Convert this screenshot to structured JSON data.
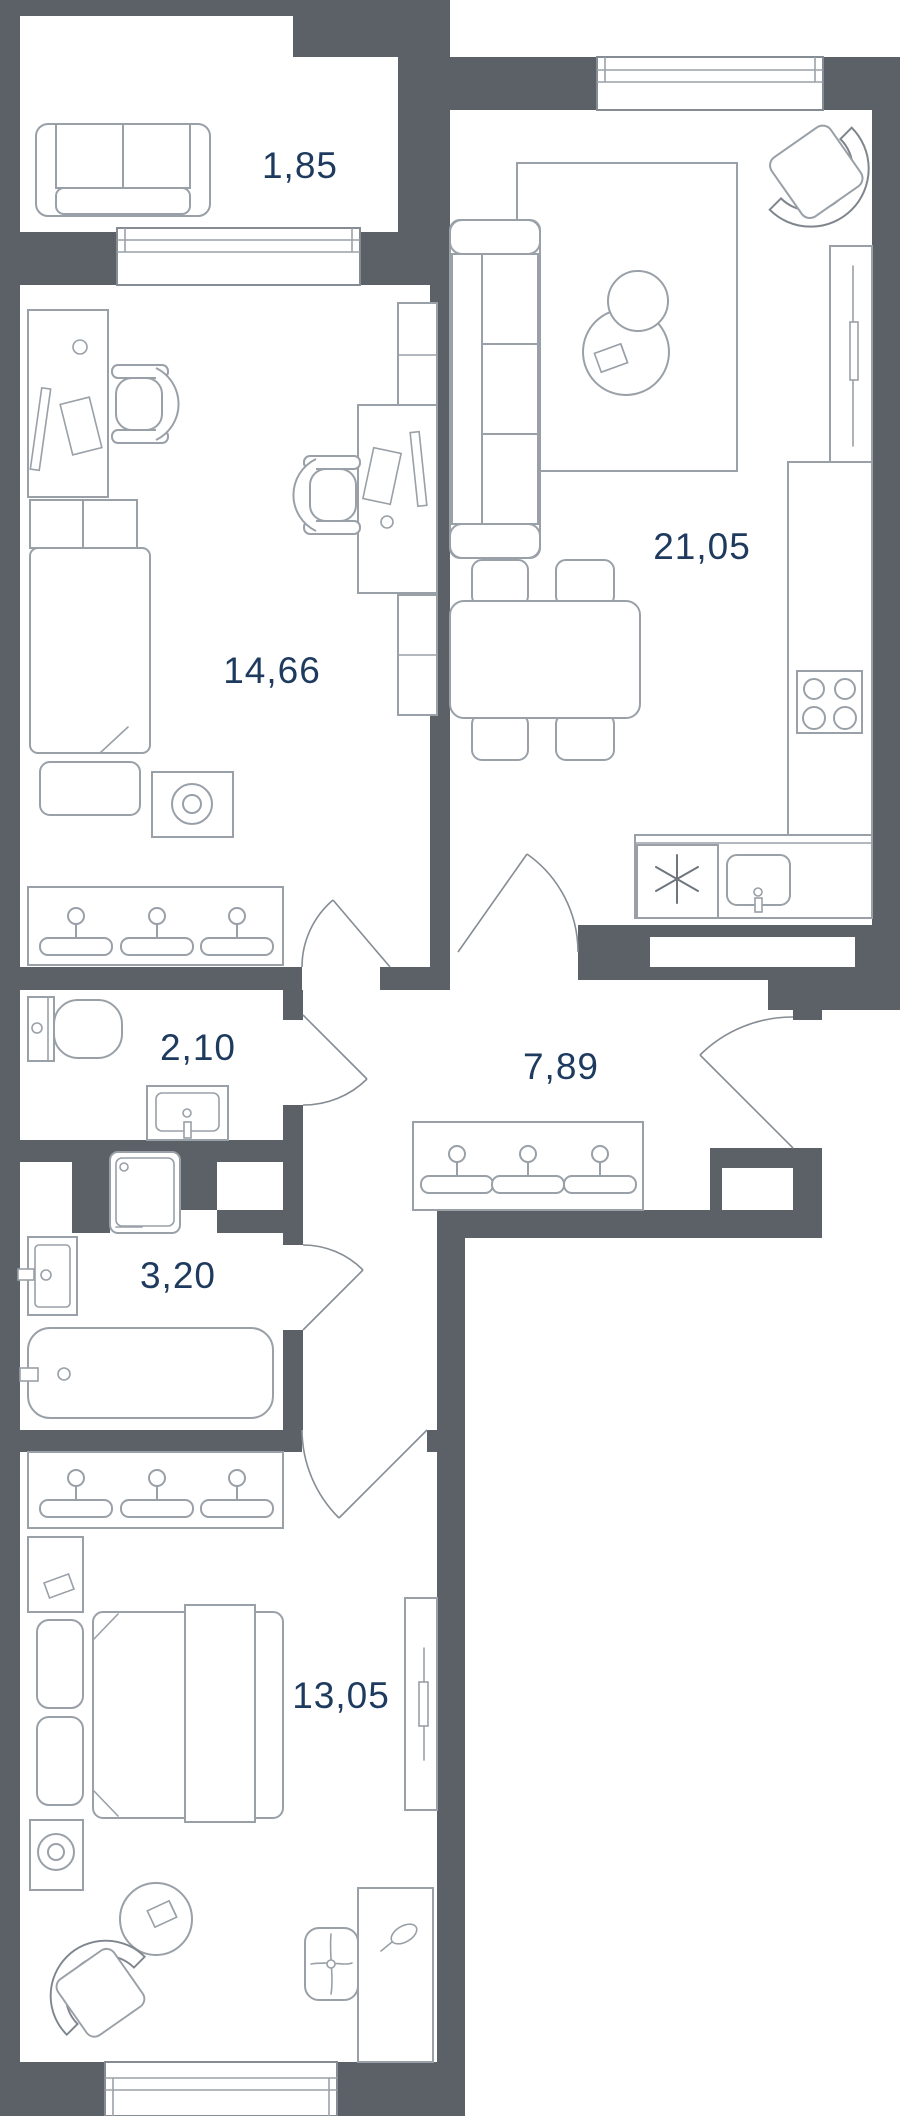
{
  "plan": {
    "title": "apartment-floor-plan",
    "colors": {
      "wall": "#5B6167",
      "furniture_line": "#99A0A7",
      "label_text": "#1E3A5E",
      "background": "#FFFFFF"
    },
    "canvas": {
      "width": 900,
      "height": 2116
    },
    "rooms": [
      {
        "id": "balcony",
        "label": "1,85",
        "furniture": [
          "sofa"
        ]
      },
      {
        "id": "living-kitchen",
        "label": "21,05",
        "furniture": [
          "sofa",
          "rug",
          "coffee-tables",
          "armchair",
          "tv-console",
          "dining-table",
          "chairs",
          "kitchen-counter",
          "stove",
          "sink",
          "dishwasher"
        ]
      },
      {
        "id": "bedroom-office",
        "label": "14,66",
        "furniture": [
          "desk",
          "office-chair",
          "second-desk",
          "shelving",
          "bed",
          "bench",
          "lamp-table",
          "wardrobe-hangers"
        ]
      },
      {
        "id": "toilet",
        "label": "2,10",
        "furniture": [
          "toilet",
          "washbasin"
        ]
      },
      {
        "id": "hallway",
        "label": "7,89",
        "furniture": [
          "wardrobe-hangers"
        ]
      },
      {
        "id": "bathroom",
        "label": "3,20",
        "furniture": [
          "washing-machine",
          "washbasin",
          "bathtub"
        ]
      },
      {
        "id": "bedroom",
        "label": "13,05",
        "furniture": [
          "wardrobe-hangers",
          "double-bed",
          "nightstand-lamp",
          "round-rug",
          "armchair",
          "pouf",
          "vanity-desk",
          "dresser"
        ]
      }
    ]
  }
}
